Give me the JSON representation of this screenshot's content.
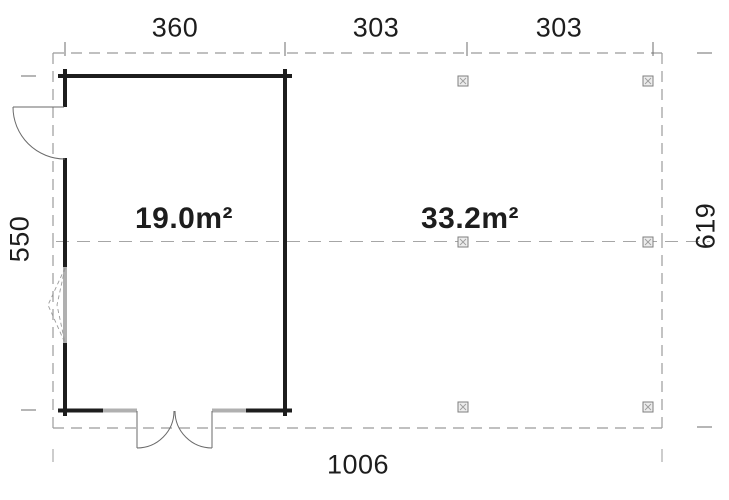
{
  "drawing_type": "floor-plan",
  "dimensions": {
    "top": [
      "360",
      "303",
      "303"
    ],
    "left": "550",
    "right": "619",
    "bottom": "1006"
  },
  "areas": {
    "cabin": "19.0m²",
    "carport": "33.2m²"
  },
  "colors": {
    "wall": "#1d1d1d",
    "dashed_outline": "#9b9b9b",
    "centerline": "#a6a6a6",
    "dimension_text": "#1d1d1d",
    "window_glazing": "#b0b0b0",
    "door_swing": "#6a6a6a",
    "post_fill": "#ededed",
    "post_border": "#7f7f7f",
    "background": "#ffffff"
  }
}
